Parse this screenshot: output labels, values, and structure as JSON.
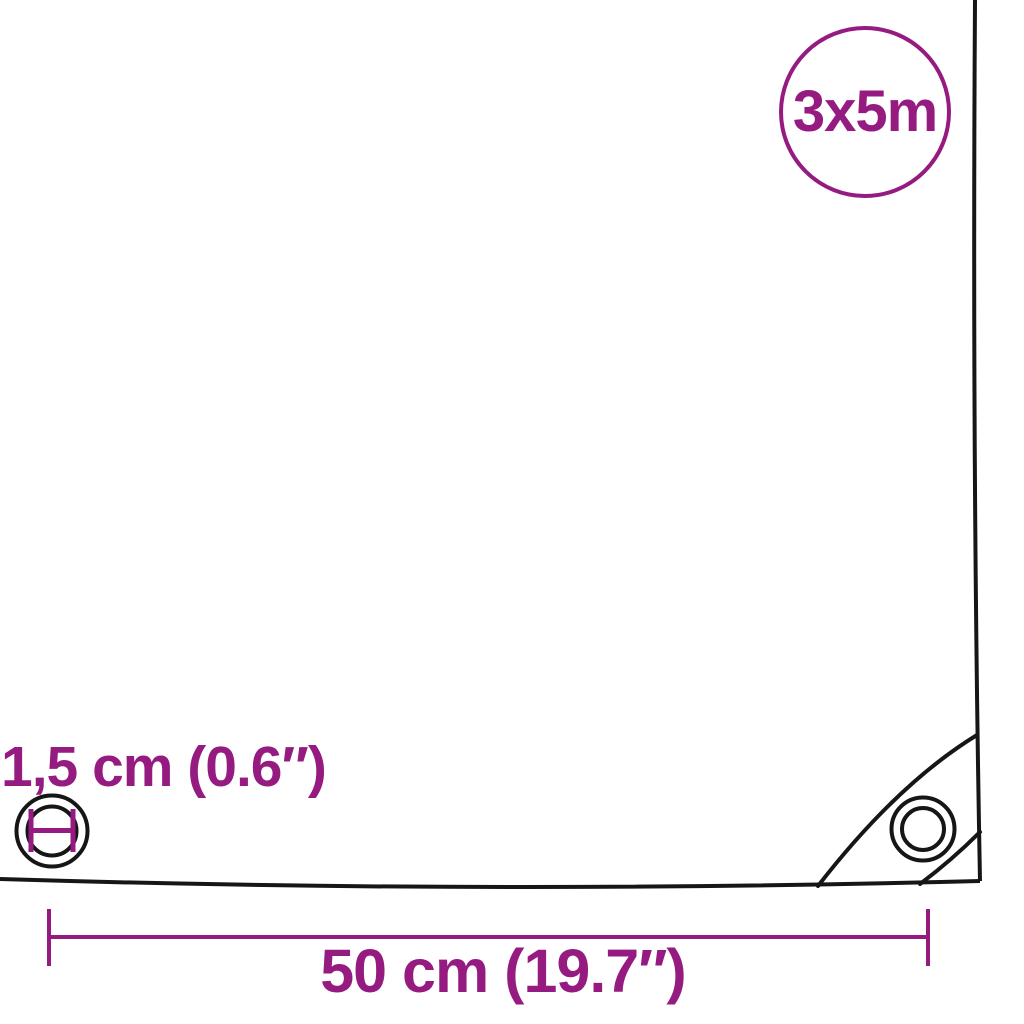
{
  "page": {
    "background": "#ffffff"
  },
  "colors": {
    "accent": "#951b81",
    "outline": "#161616",
    "surface": "#ffffff"
  },
  "size_badge": {
    "label": "3x5m"
  },
  "labels": {
    "eyelet_diameter": "1,5 cm (0.6″)",
    "eyelet_spacing": "50 cm (19.7″)"
  },
  "icons": {
    "eyelet": "eyelet-grommet-icon",
    "corner_eyelet": "corner-grommet-icon",
    "diameter_marker": "diameter-marker-icon"
  }
}
